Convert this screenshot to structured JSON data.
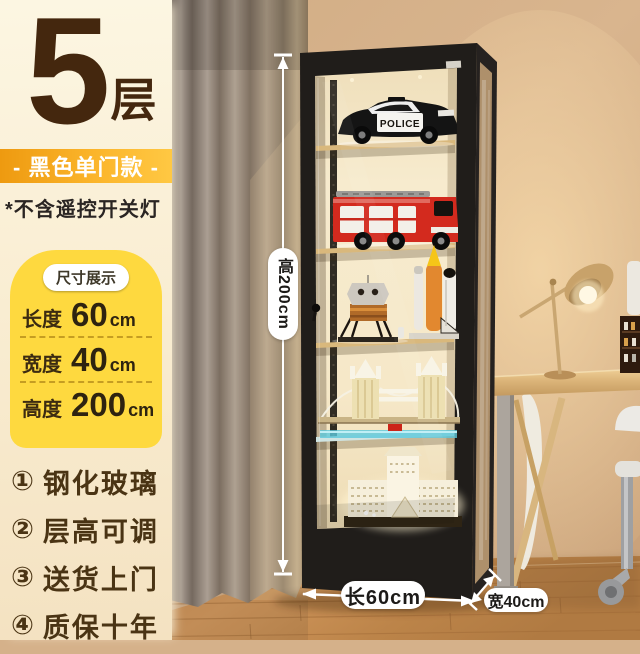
{
  "panel": {
    "tier_number": "5",
    "tier_unit": "层",
    "variant_badge": "- 黑色单门款 -",
    "note": "*不含遥控开关灯",
    "size_box": {
      "title": "尺寸展示",
      "rows": [
        {
          "label": "长度",
          "value": "60",
          "unit": "cm"
        },
        {
          "label": "宽度",
          "value": "40",
          "unit": "cm"
        },
        {
          "label": "高度",
          "value": "200",
          "unit": "cm"
        }
      ]
    },
    "features": [
      {
        "num": "①",
        "text": "钢化玻璃"
      },
      {
        "num": "②",
        "text": "层高可调"
      },
      {
        "num": "③",
        "text": "送货上门"
      },
      {
        "num": "④",
        "text": "质保十年"
      }
    ]
  },
  "dimensions": {
    "height_label": "高200cm",
    "length_label": "长60cm",
    "width_label": "宽40cm"
  },
  "cabinet": {
    "police_text": "POLICE",
    "shelf_items": [
      "police-car",
      "fire-truck",
      "lunar-lander-and-space-shuttle",
      "tower-bridge",
      "louvre-building"
    ]
  },
  "colors": {
    "panel_cream": "#FBF3DC",
    "size_box_yellow": "#FED93F",
    "badge_orange": "#F2A019",
    "headline_brown": "#44270E",
    "cabinet_black": "#201D1A",
    "interior_warm": "#F6E9CA",
    "wall_beige": "#D5B18A",
    "floor_wood": "#C68A4E",
    "dimension_white": "#FFFFFF"
  }
}
